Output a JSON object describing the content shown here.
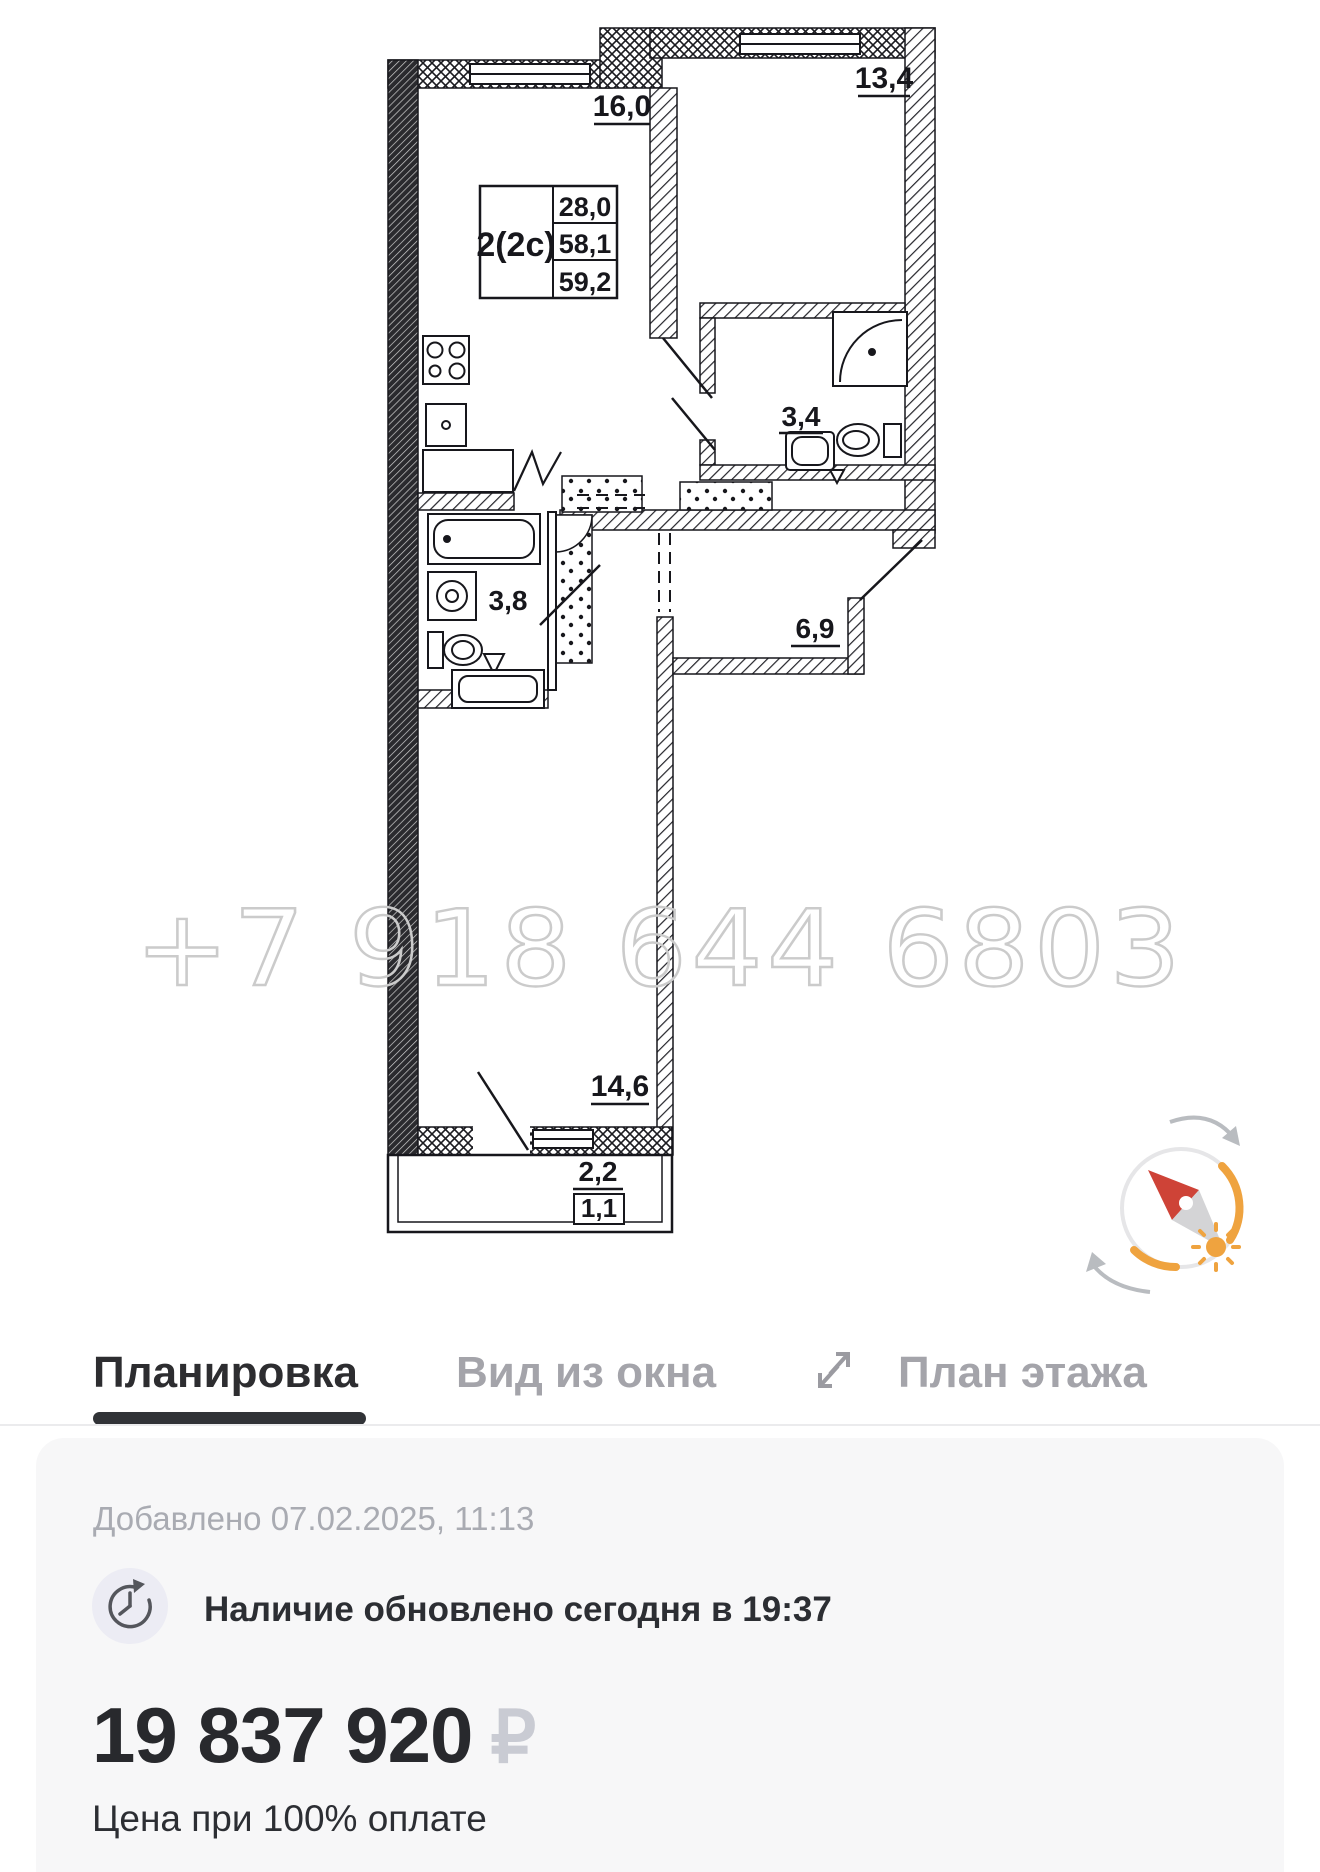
{
  "plan": {
    "watermark": "+7 918 644 6803",
    "spec": {
      "type": "2(2с)",
      "v1": "28,0",
      "v2": "58,1",
      "v3": "59,2"
    },
    "areas": {
      "kitchen": "16,0",
      "bedroom": "13,4",
      "bath_small": "3,4",
      "bath": "3,8",
      "hallway": "6,9",
      "living": "14,6",
      "balcony": "2,2",
      "balcony_reduced": "1,1"
    }
  },
  "tabs": {
    "planning": "Планировка",
    "window_view": "Вид из окна",
    "floor_plan": "План этажа"
  },
  "info": {
    "added": "Добавлено 07.02.2025, 11:13",
    "availability": "Наличие обновлено сегодня в 19:37",
    "price": "19 837 920",
    "currency": "₽",
    "note": "Цена при 100% оплате"
  },
  "icons": {
    "tabs_expand": "diagonal-resize-arrows",
    "availability": "clock-refresh",
    "plan_overlay": "compass-with-sun"
  },
  "colors": {
    "accent_orange": "#EFA33F",
    "needle_red": "#CE4337",
    "watermark_gray": "#CBCBCB",
    "currency_gray": "#C9CBD3",
    "inactive_tab": "#A4A4AA",
    "card_bg": "#F7F7F8"
  }
}
